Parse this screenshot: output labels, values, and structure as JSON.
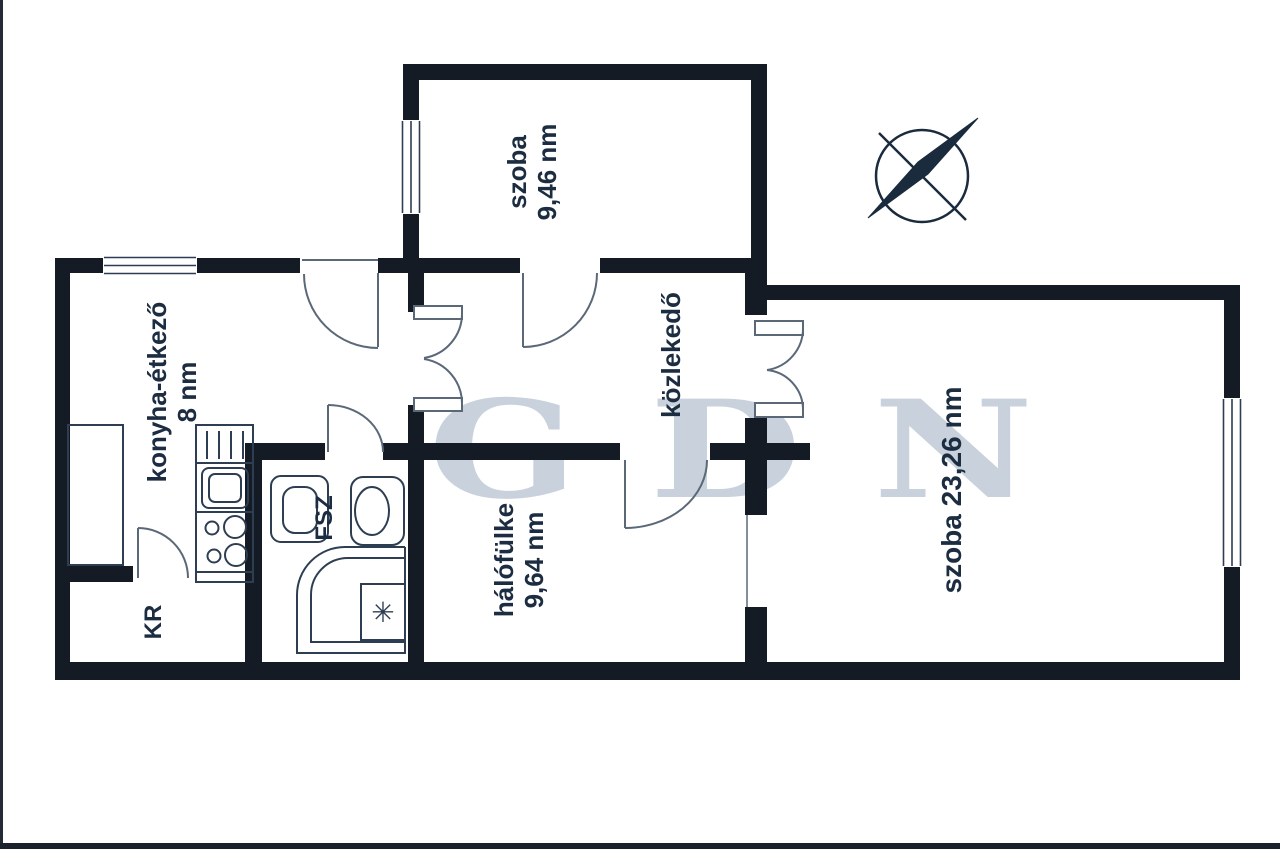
{
  "title": "apartment floor plan",
  "watermark": {
    "text": "GDN"
  },
  "rooms": {
    "room_top": {
      "name": "szoba",
      "area": "9,46 nm"
    },
    "kitchen": {
      "name": "konyha-étkező",
      "area": "8 nm"
    },
    "hallway": {
      "name": "közlekedő"
    },
    "room_right": {
      "name": "szoba 23,26 nm"
    },
    "alcove": {
      "name": "hálófülke",
      "area": "9,64 nm"
    },
    "pantry": {
      "name": "KR"
    },
    "bathroom": {
      "name": "FSZ"
    }
  },
  "symbols": {
    "shower_star": "✳"
  },
  "colors": {
    "wall": "#141b24",
    "door_line": "#5a6878",
    "fixture_line": "#2e3e52",
    "label_text": "#1c2d42",
    "watermark": "#94a6ba",
    "compass": "#1a2b3d"
  }
}
